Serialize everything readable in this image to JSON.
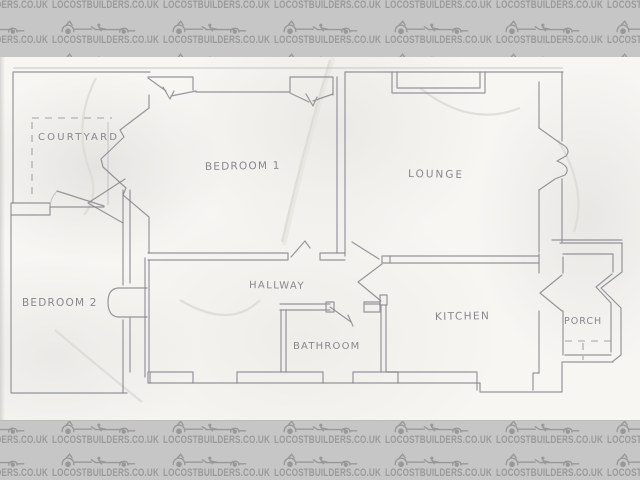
{
  "watermark": {
    "text": "LOCOSTBUILDERS.CO.UK",
    "logo_icon": "kit-car-logo",
    "band_bg": "#c6c6c6",
    "text_color": "#9a9a9a"
  },
  "floor_plan": {
    "pencil_color": "#85858f",
    "rooms": [
      {
        "id": "courtyard",
        "label": "COURTYARD"
      },
      {
        "id": "bedroom1",
        "label": "BEDROOM 1"
      },
      {
        "id": "lounge",
        "label": "LOUNGE"
      },
      {
        "id": "bedroom2",
        "label": "BEDROOM 2"
      },
      {
        "id": "hallway",
        "label": "HALLWAY"
      },
      {
        "id": "bathroom",
        "label": "BATHROOM"
      },
      {
        "id": "kitchen",
        "label": "KITCHEN"
      },
      {
        "id": "porch",
        "label": "PORCH"
      }
    ]
  }
}
